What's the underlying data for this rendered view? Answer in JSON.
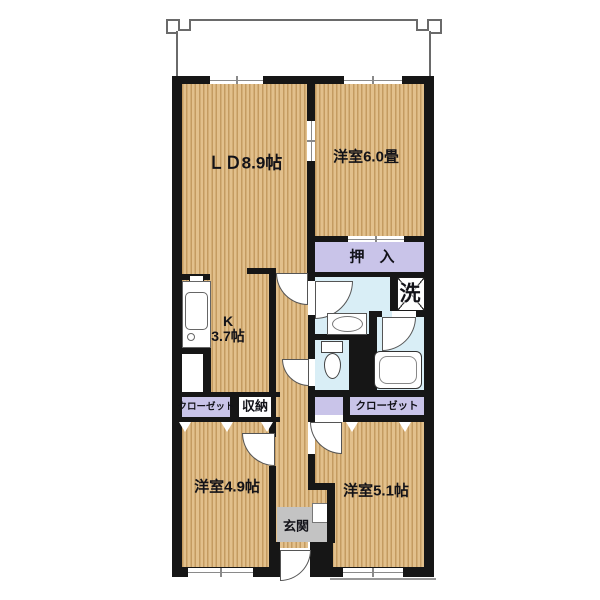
{
  "plan": {
    "type": "japanese-apartment-floor-plan",
    "rooms": {
      "ld": {
        "label": "ＬＤ8.9帖"
      },
      "western6": {
        "label": "洋室6.0畳"
      },
      "oshiire": {
        "label": "押　入"
      },
      "kitchen": {
        "label_line1": "K",
        "label_line2": "3.7帖"
      },
      "laundry": {
        "label": "洗"
      },
      "closet_left": {
        "label": "クローゼット"
      },
      "storage": {
        "label": "収納"
      },
      "closet_right": {
        "label": "クローゼット"
      },
      "western49": {
        "label": "洋室4.9帖"
      },
      "western51": {
        "label": "洋室5.1帖"
      },
      "entrance": {
        "label": "玄関"
      }
    },
    "colors": {
      "wood_base": "#e2c08c",
      "wood_stripe": "#c49b61",
      "closet_fill": "#c9c4e9",
      "wet_area_fill": "#d9eef6",
      "entrance_floor": "#c3c3c3",
      "wall": "#161616"
    },
    "fixtures": [
      "kitchen-sink",
      "refrigerator-space",
      "washbasin",
      "toilet",
      "bathtub",
      "washing-machine-space",
      "balcony"
    ]
  }
}
